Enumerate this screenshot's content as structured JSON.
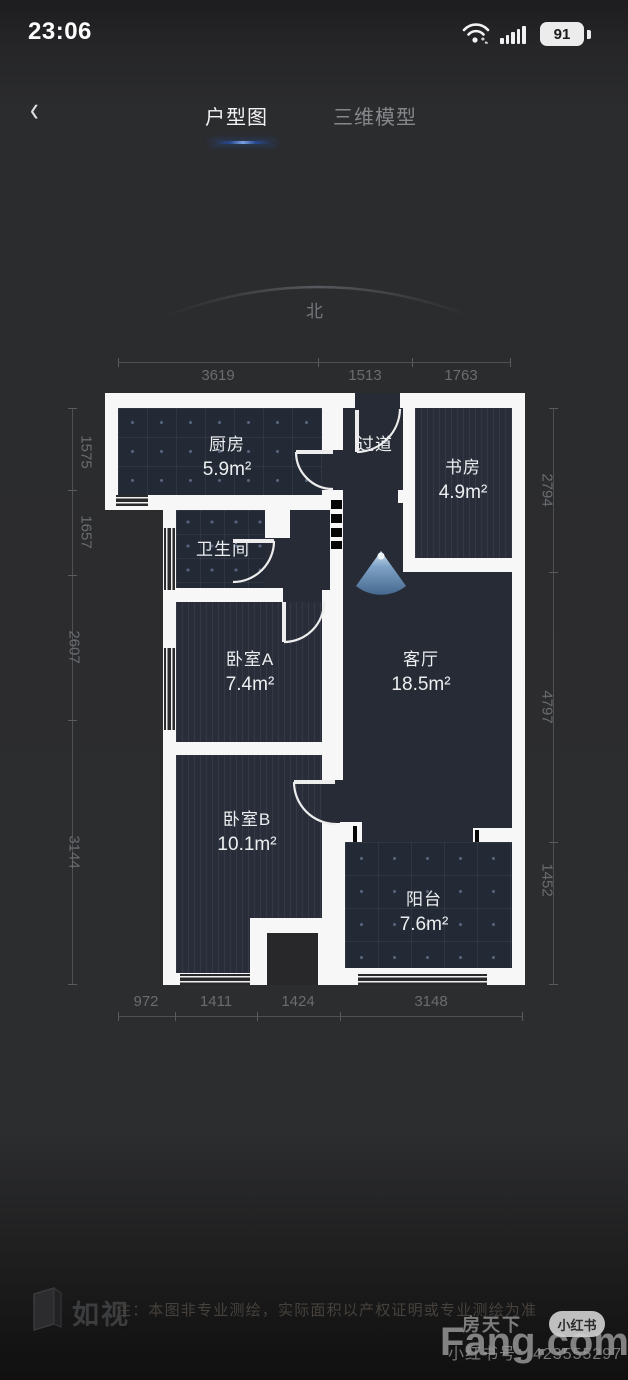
{
  "status_bar": {
    "time": "23:06",
    "battery_percent": "91"
  },
  "nav": {
    "back_label": "‹",
    "tabs": [
      {
        "label": "户型图",
        "active": true
      },
      {
        "label": "三维模型",
        "active": false
      }
    ]
  },
  "compass": {
    "label": "北"
  },
  "floor_plan": {
    "rooms": [
      {
        "id": "kitchen",
        "name": "厨房",
        "area": "5.9m²"
      },
      {
        "id": "hallway",
        "name": "过道",
        "area": ""
      },
      {
        "id": "study",
        "name": "书房",
        "area": "4.9m²"
      },
      {
        "id": "bathroom",
        "name": "卫生间",
        "area": ""
      },
      {
        "id": "bedroom_a",
        "name": "卧室A",
        "area": "7.4m²"
      },
      {
        "id": "living",
        "name": "客厅",
        "area": "18.5m²"
      },
      {
        "id": "bedroom_b",
        "name": "卧室B",
        "area": "10.1m²"
      },
      {
        "id": "balcony",
        "name": "阳台",
        "area": "7.6m²"
      }
    ],
    "dimensions_mm": {
      "top": [
        "3619",
        "1513",
        "1763"
      ],
      "bottom": [
        "972",
        "1411",
        "1424",
        "3148"
      ],
      "left": [
        "1575",
        "1657",
        "2607",
        "3144"
      ],
      "right": [
        "2794",
        "4797",
        "1452"
      ]
    }
  },
  "footer": {
    "brand": "如视",
    "note": "注：本图非专业测绘，实际面积以产权证明或专业测绘为准"
  },
  "watermark": {
    "site_cn": "房天下",
    "site_en": "Fang.com",
    "badge": "小红书",
    "account": "小红书号：423555297"
  },
  "colors": {
    "accent_blue": "#4a79c9",
    "wall_white": "#f7f7f7",
    "room_dark": "#272b35",
    "fan_blue": "#5d84ad"
  }
}
